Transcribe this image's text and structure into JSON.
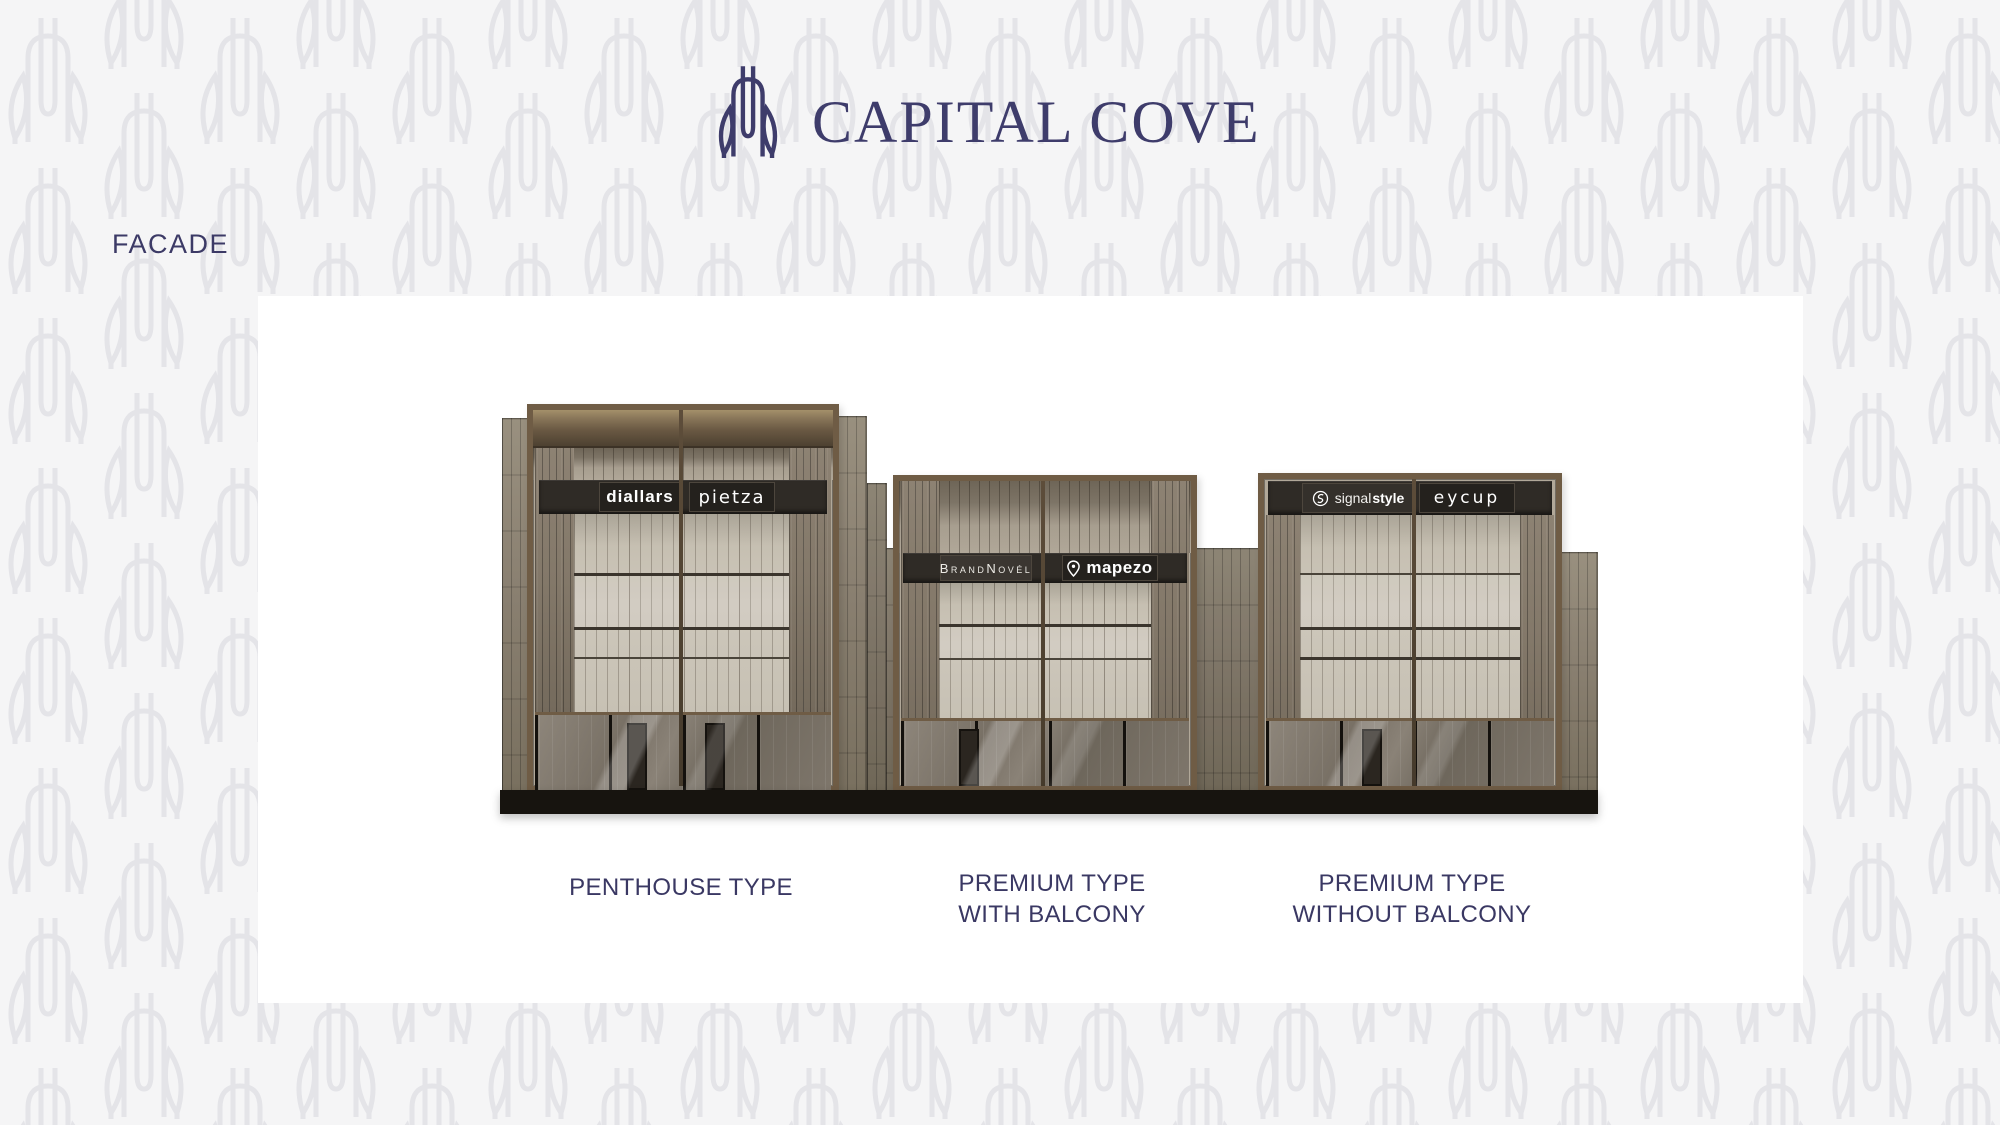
{
  "header": {
    "brand_name": "CAPITAL COVE",
    "logo": "tulip-logo"
  },
  "section": {
    "label": "FACADE"
  },
  "facade_board": {
    "buildings": [
      {
        "id": "penthouse",
        "caption_line1": "PENTHOUSE TYPE",
        "caption_line2": "",
        "signs": {
          "left": "diallars",
          "right": "pietza"
        }
      },
      {
        "id": "premium-with-balcony",
        "caption_line1": "PREMIUM TYPE",
        "caption_line2": "WITH BALCONY",
        "signs": {
          "left": "BrandNovél",
          "right": "mapezo",
          "right_icon": "map-pin-icon"
        }
      },
      {
        "id": "premium-without-balcony",
        "caption_line1": "PREMIUM TYPE",
        "caption_line2": "WITHOUT BALCONY",
        "signs": {
          "left_light": "signal",
          "left_bold": "style",
          "left_icon": "swirl-icon",
          "right": "eycup"
        }
      }
    ]
  },
  "colors": {
    "brand_navy": "#3e3c6b",
    "caption_navy": "#3a3863",
    "background": "#f5f5f6",
    "pattern_stroke": "#e4e4e8",
    "panel_white": "#ffffff",
    "frame_bronze": "#6f5c45",
    "sign_dark": "#2f2b26",
    "glass_light": "#cbc5b9",
    "pier_taupe": "#837869",
    "base_black": "#17140f"
  }
}
